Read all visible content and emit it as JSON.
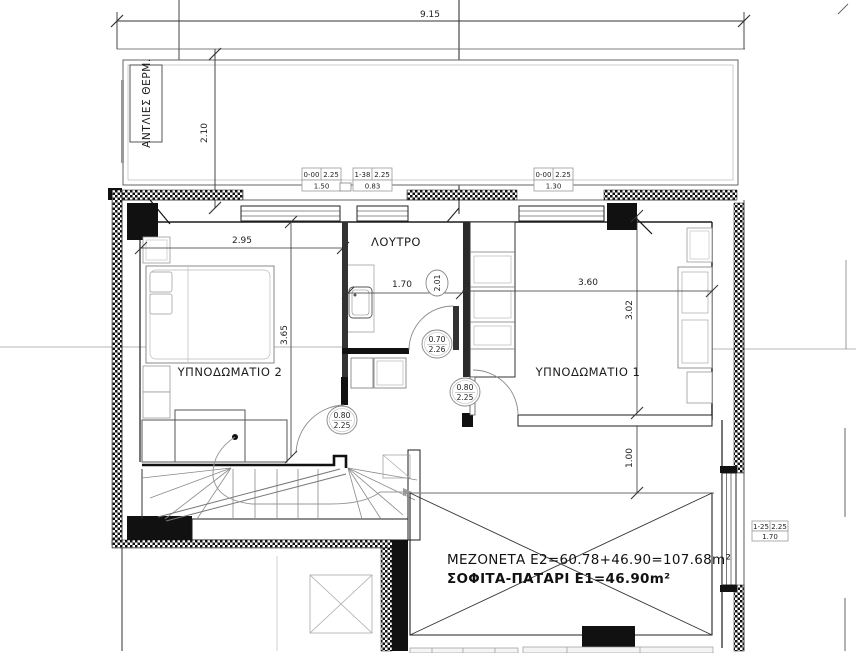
{
  "rooms": {
    "bedroom2": "ΥΠΝΟΔΩΜΑΤΙΟ 2",
    "bedroom1": "ΥΠΝΟΔΩΜΑΤΙΟ 1",
    "bathroom": "ΛΟΥΤΡΟ",
    "pump_area": "ΑΝΤΛΙΕΣ ΘΕΡΜ."
  },
  "area_labels": {
    "line1": "ΜΕΖΟΝΕΤΑ Ε2=60.78+46.90=107.68m²",
    "line2": "ΣΟΦΙΤΑ-ΠΑΤΑΡΙ Ε1=46.90m²"
  },
  "dimensions": {
    "overall_width": "9.15",
    "terrace_depth": "2.10",
    "bedroom2_width": "2.95",
    "bedroom2_depth": "3.65",
    "bathroom_width": "1.70",
    "bathroom_note": "2.01",
    "bedroom1_width": "3.60",
    "bedroom1_depth": "3.02",
    "walkway_depth": "1.00"
  },
  "door_tags": {
    "bathroom": {
      "width": "0.70",
      "height": "2.26"
    },
    "bedroom1": {
      "width": "0.80",
      "height": "2.25"
    },
    "hall": {
      "width": "0.80",
      "height": "2.25"
    }
  },
  "window_tags": {
    "w1": {
      "sill": "0-00",
      "head": "2.25",
      "width": "1.50"
    },
    "w2": {
      "sill": "1-38",
      "head": "2.25",
      "width": "0.83"
    },
    "w3": {
      "sill": "0-00",
      "head": "2.25",
      "width": "1.30"
    },
    "w4": {
      "sill": "1-25",
      "head": "2.25",
      "width": "1.70"
    }
  },
  "colors": {
    "line": "#1c1c1c",
    "furniture": "#999999",
    "dim": "#333333",
    "solid": "#111111"
  }
}
